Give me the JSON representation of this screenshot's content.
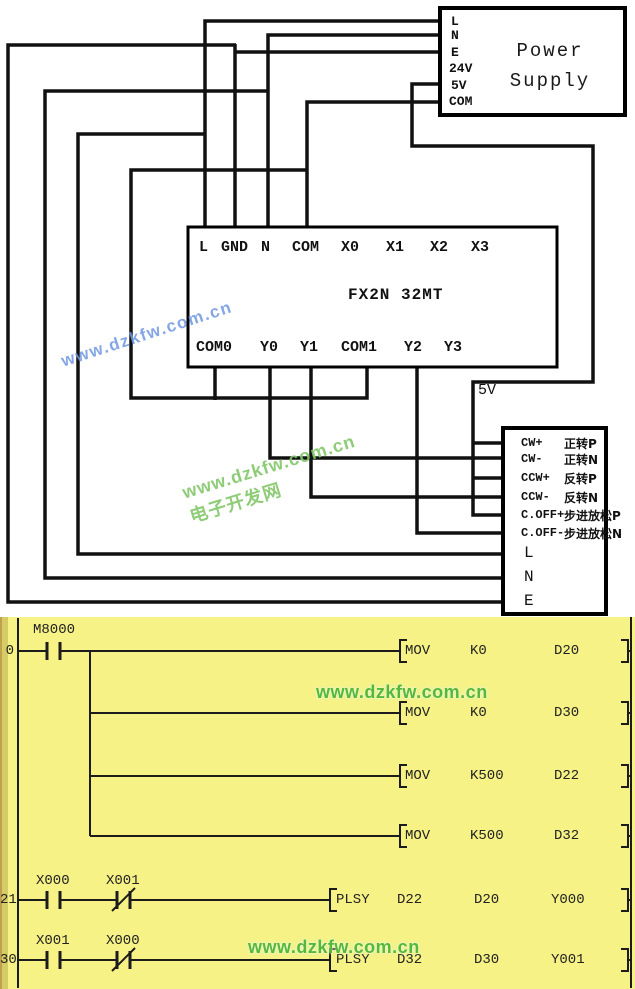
{
  "wiring": {
    "power_supply": {
      "title_line1": "Power",
      "title_line2": "Supply",
      "terminals": [
        "L",
        "N",
        "E",
        "24V",
        "5V",
        "COM"
      ]
    },
    "plc": {
      "model": "FX2N 32MT",
      "top_terminals": [
        "L",
        "GND",
        "N",
        "COM",
        "X0",
        "X1",
        "X2",
        "X3"
      ],
      "bottom_terminals": [
        "COM0",
        "Y0",
        "Y1",
        "COM1",
        "Y2",
        "Y3"
      ]
    },
    "driver": {
      "signal_terminals": [
        {
          "en": "CW+",
          "cn": "正转P"
        },
        {
          "en": "CW-",
          "cn": "正转N"
        },
        {
          "en": "CCW+",
          "cn": "反转P"
        },
        {
          "en": "CCW-",
          "cn": "反转N"
        },
        {
          "en": "C.OFF+",
          "cn": "步进放松P"
        },
        {
          "en": "C.OFF-",
          "cn": "步进放松N"
        }
      ],
      "power_terminals": [
        "L",
        "N",
        "E"
      ]
    },
    "labels": {
      "five_v": "5V"
    }
  },
  "watermarks": {
    "blue": "www.dzkfw.com.cn",
    "green_url": "www.dzkfw.com.cn",
    "green_site": "电子开发网",
    "ladder_top": "www.dzkfw.com.cn",
    "ladder_bottom": "www.dzkfw.com.cn"
  },
  "ladder": {
    "rung0": {
      "number": "0",
      "contact": "M8000",
      "instructions": [
        {
          "op": "MOV",
          "s": "K0",
          "d": "D20"
        },
        {
          "op": "MOV",
          "s": "K0",
          "d": "D30"
        },
        {
          "op": "MOV",
          "s": "K500",
          "d": "D22"
        },
        {
          "op": "MOV",
          "s": "K500",
          "d": "D32"
        }
      ]
    },
    "rung21": {
      "number": "21",
      "contact1": "X000",
      "contact2": "X001",
      "instruction": {
        "op": "PLSY",
        "s1": "D22",
        "s2": "D20",
        "d": "Y000"
      }
    },
    "rung30": {
      "number": "30",
      "contact1": "X001",
      "contact2": "X000",
      "instruction": {
        "op": "PLSY",
        "s1": "D32",
        "s2": "D30",
        "d": "Y001"
      }
    }
  },
  "colors": {
    "ladder_bg": "#F7F285",
    "ladder_strip": "#D6CC66",
    "wire": "#111111",
    "watermark_blue": "#6E96E1",
    "watermark_green": "#82C669",
    "ladder_watermark_green": "#55B838"
  }
}
